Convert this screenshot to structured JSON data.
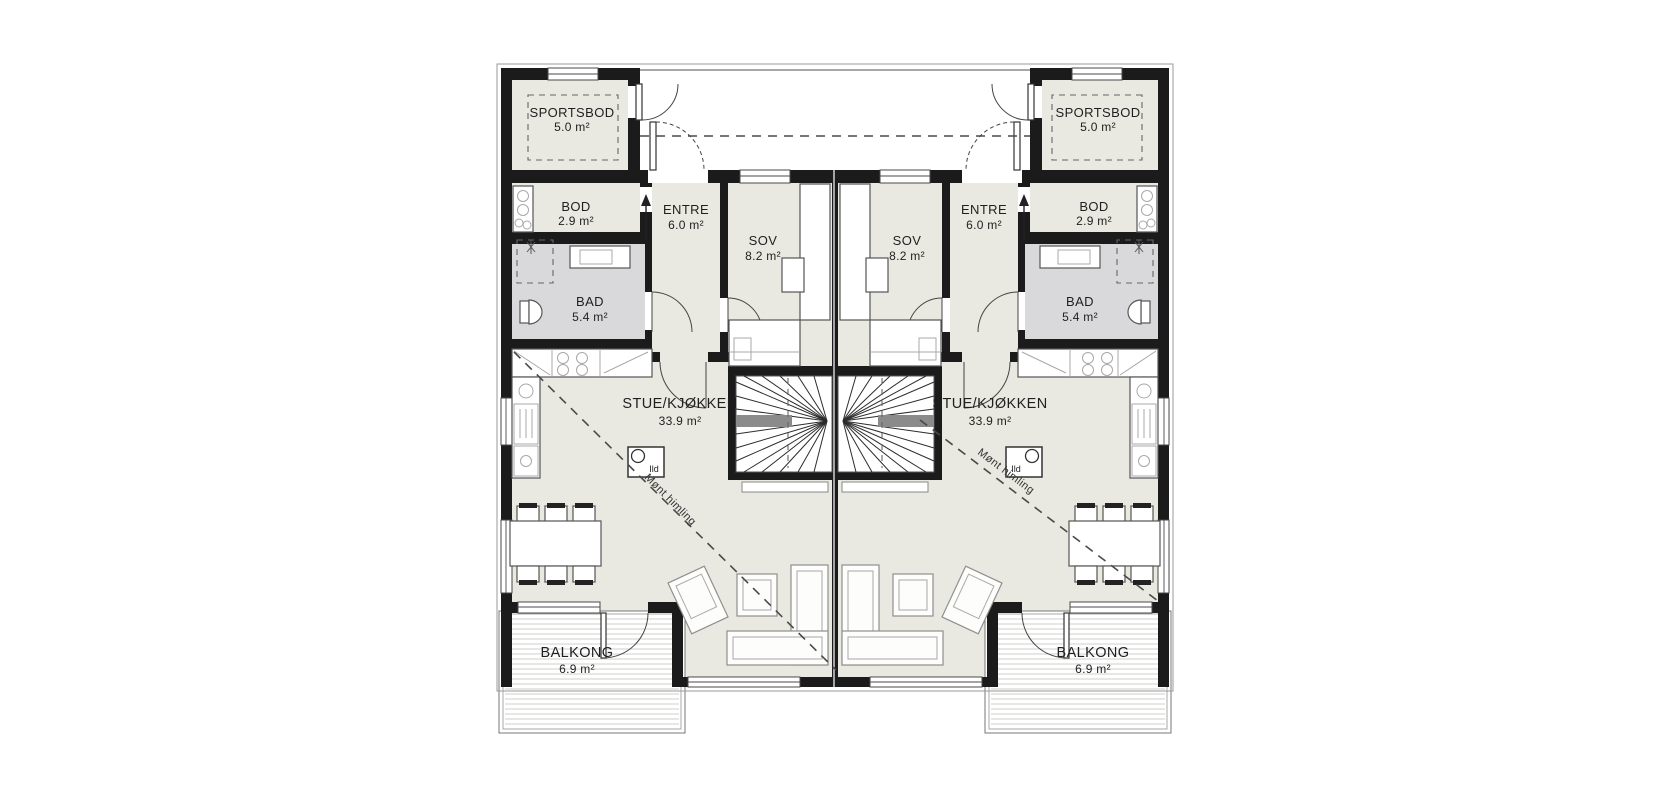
{
  "plan": {
    "type": "floor-plan",
    "rooms": {
      "sportsbod": {
        "name": "SPORTSBOD",
        "area": "5.0 m²"
      },
      "bod": {
        "name": "BOD",
        "area": "2.9 m²"
      },
      "entre": {
        "name": "ENTRE",
        "area": "6.0 m²"
      },
      "sov": {
        "name": "SOV",
        "area": "8.2 m²"
      },
      "bad": {
        "name": "BAD",
        "area": "5.4 m²"
      },
      "stue_kjokken": {
        "name": "STUE/KJØKKEN",
        "area": "33.9 m²"
      },
      "balkong": {
        "name": "BALKONG",
        "area": "6.9 m²"
      }
    },
    "annotations": {
      "ridge": "Mønt himling",
      "fireplace": "Ild"
    },
    "colors": {
      "wall": "#1b1b1b",
      "floor": "#e9e8e1",
      "bath_floor": "#d9d9db",
      "background": "#ffffff"
    }
  }
}
